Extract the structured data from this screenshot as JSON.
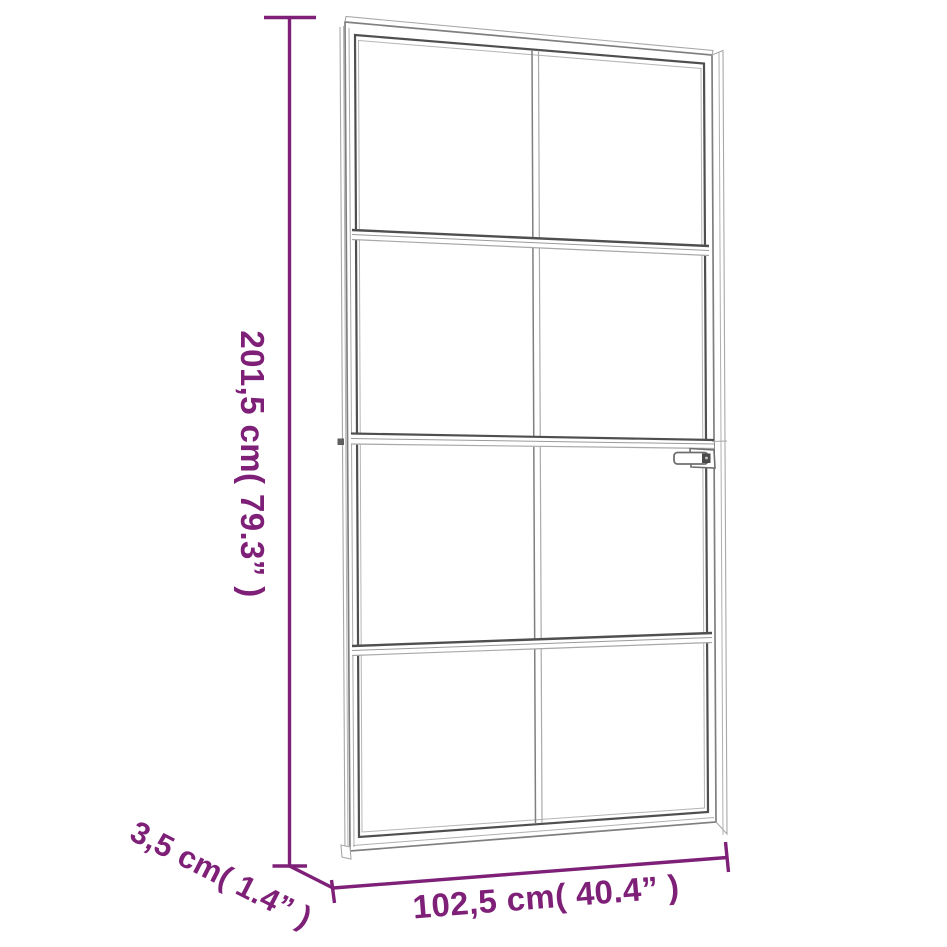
{
  "diagram": {
    "background_color": "#ffffff",
    "accent_color": "#7E2077",
    "door_line_color": "#7f7f7f",
    "product": "interior glass door with black aluminium frame, 8 glass panes and lever handle",
    "dimensions": {
      "height": {
        "label": "201,5 cm( 79.3” )",
        "cm": "201,5",
        "inches": "79.3"
      },
      "width": {
        "label": "102,5 cm( 40.4” )",
        "cm": "102,5",
        "inches": "40.4"
      },
      "depth": {
        "label": "3,5 cm( 1.4” )",
        "cm": "3,5",
        "inches": "1.4"
      }
    }
  }
}
